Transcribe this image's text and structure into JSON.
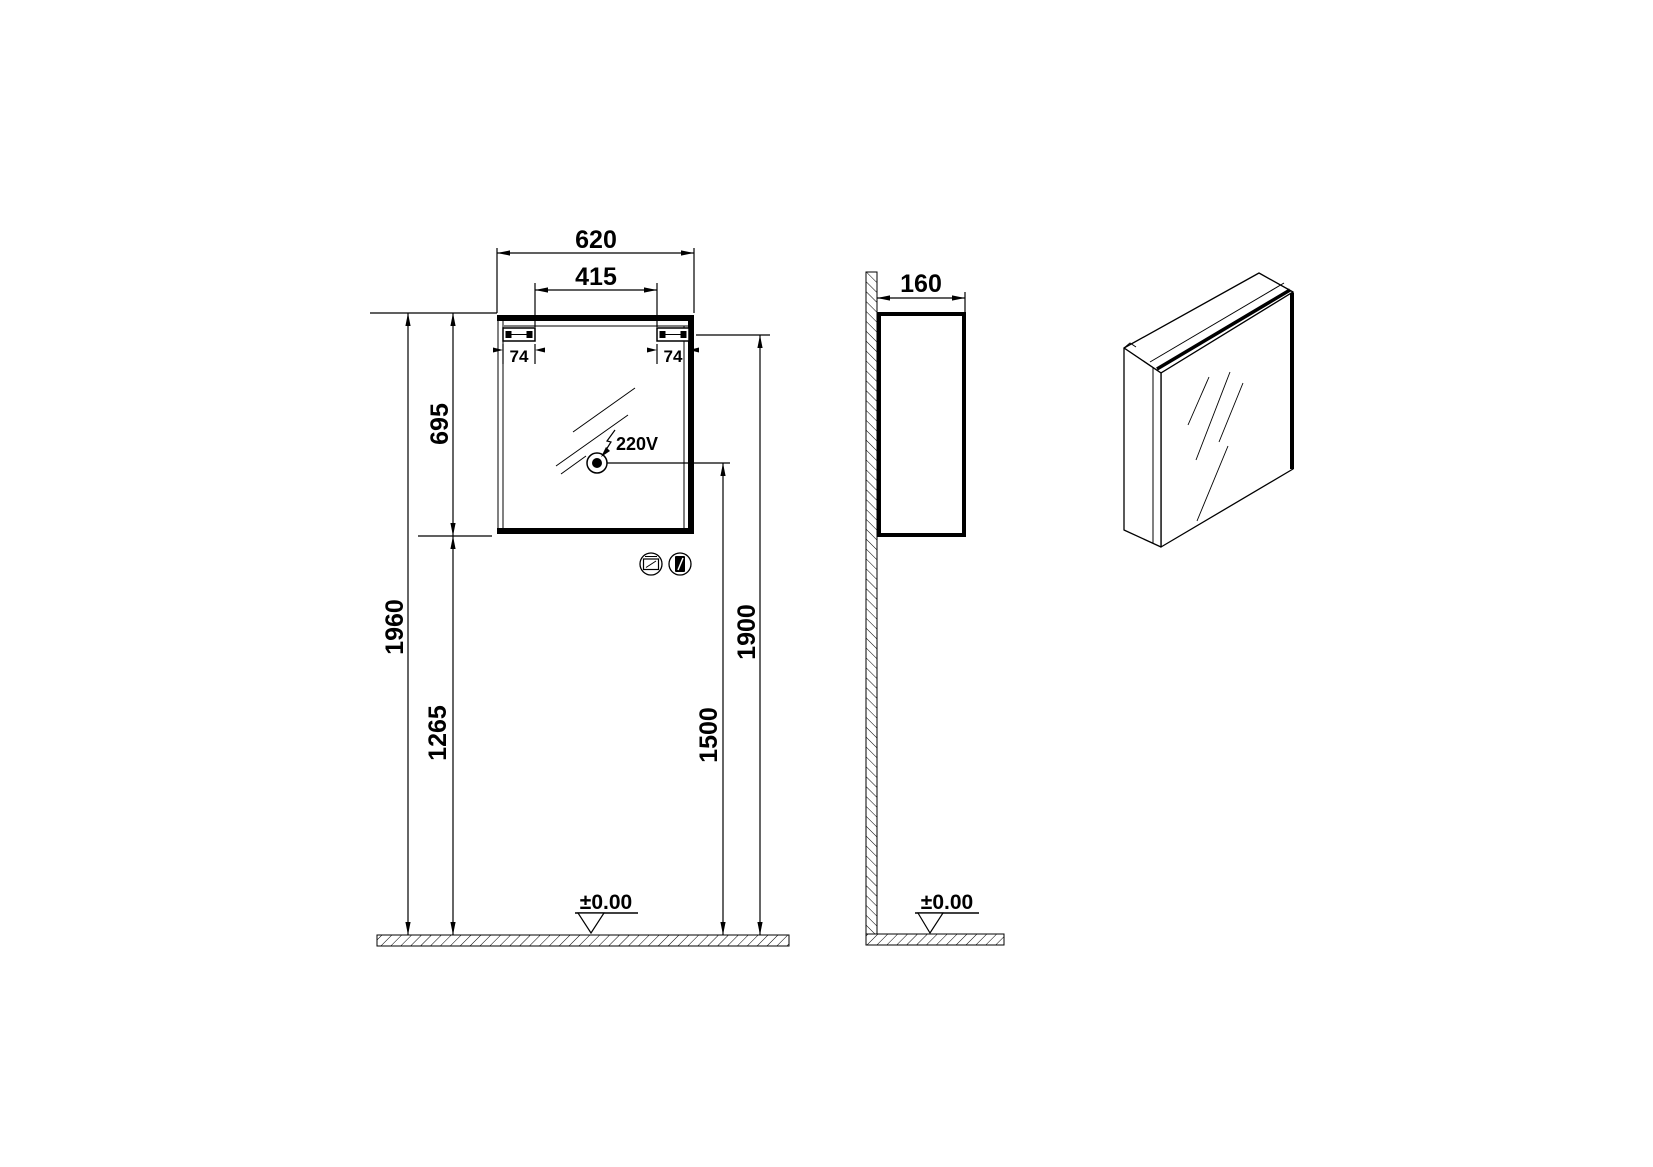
{
  "drawing": {
    "background": "#ffffff",
    "ink": "#000000",
    "views": {
      "front": "front elevation",
      "side": "side elevation",
      "iso": "isometric view"
    }
  },
  "front": {
    "dim_width": "620",
    "dim_mirror_width": "415",
    "dim_hinge_left": "74",
    "dim_hinge_right": "74",
    "dim_cabinet_height": "695",
    "dim_total_height": "1960",
    "dim_floor_to_cabinet_bottom": "1265",
    "dim_floor_to_mounting_rail": "1900",
    "dim_floor_to_socket": "1500",
    "socket_label": "220V",
    "floor_level": "±0.00",
    "icons": {
      "feature_1": "mirror-cabinet-feature-icon",
      "feature_2": "door-feature-icon"
    }
  },
  "side": {
    "dim_depth": "160",
    "floor_level": "±0.00"
  }
}
